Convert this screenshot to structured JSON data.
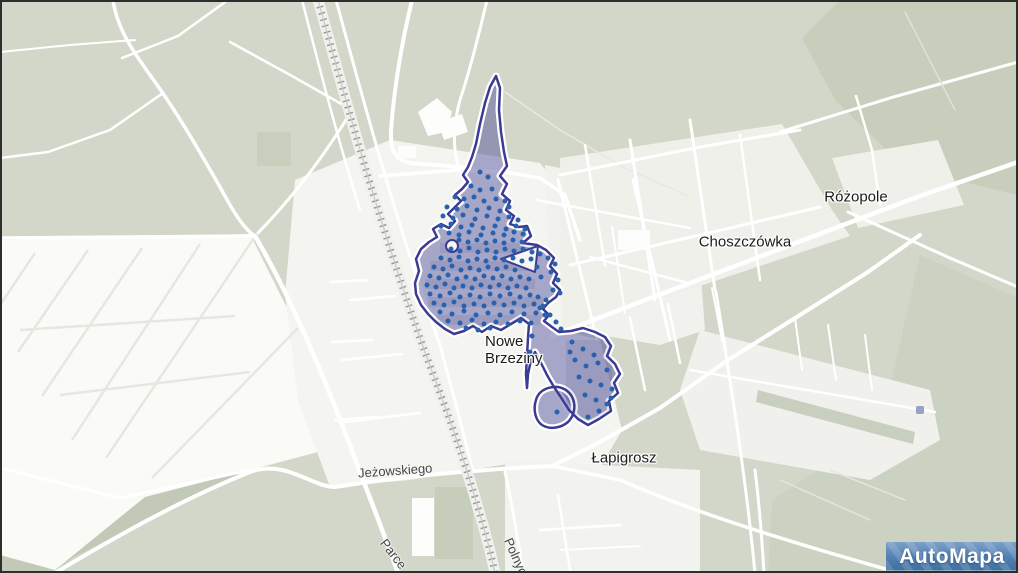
{
  "map": {
    "place_labels": [
      {
        "text": "Różopole"
      },
      {
        "text": "Choszczówka"
      },
      {
        "line1": "Nowe",
        "line2": "Brzeziny"
      },
      {
        "text": "Łapigrosz"
      }
    ],
    "street_labels": [
      {
        "text": "Jeżowskiego"
      },
      {
        "text": "Parce"
      },
      {
        "text": "Polnych"
      }
    ],
    "logo": {
      "text": "AutoMapa"
    },
    "district": {
      "name": "Nowe Brzeziny",
      "fill": "rgba(70,70,150,0.45)",
      "stroke": "#3b3b94",
      "halo": "#ffffff"
    },
    "colors": {
      "base_green": "#d3d7c9",
      "dark_green": "#c7cebc",
      "urban_light": "#f4f4f0",
      "road_white": "#ffffff",
      "dot_blue": "#2a61ae",
      "railway_gray": "#9a9a98",
      "logo_blue": "#517fb0"
    },
    "building_dots": [
      [
        480,
        172
      ],
      [
        488,
        177
      ],
      [
        471,
        186
      ],
      [
        480,
        190
      ],
      [
        492,
        189
      ],
      [
        455,
        197
      ],
      [
        464,
        199
      ],
      [
        474,
        197
      ],
      [
        484,
        201
      ],
      [
        496,
        199
      ],
      [
        505,
        201
      ],
      [
        447,
        207
      ],
      [
        457,
        209
      ],
      [
        467,
        206
      ],
      [
        477,
        210
      ],
      [
        489,
        208
      ],
      [
        500,
        211
      ],
      [
        509,
        207
      ],
      [
        443,
        216
      ],
      [
        453,
        218
      ],
      [
        463,
        215
      ],
      [
        475,
        219
      ],
      [
        487,
        216
      ],
      [
        498,
        219
      ],
      [
        509,
        217
      ],
      [
        518,
        220
      ],
      [
        441,
        226
      ],
      [
        451,
        224
      ],
      [
        461,
        227
      ],
      [
        472,
        225
      ],
      [
        483,
        228
      ],
      [
        495,
        226
      ],
      [
        506,
        229
      ],
      [
        516,
        226
      ],
      [
        525,
        229
      ],
      [
        449,
        233
      ],
      [
        459,
        235
      ],
      [
        469,
        232
      ],
      [
        481,
        235
      ],
      [
        493,
        233
      ],
      [
        504,
        235
      ],
      [
        514,
        232
      ],
      [
        523,
        234
      ],
      [
        459,
        240
      ],
      [
        468,
        242
      ],
      [
        477,
        240
      ],
      [
        486,
        243
      ],
      [
        495,
        241
      ],
      [
        504,
        243
      ],
      [
        513,
        240
      ],
      [
        522,
        242
      ],
      [
        451,
        249
      ],
      [
        460,
        251
      ],
      [
        469,
        248
      ],
      [
        478,
        252
      ],
      [
        487,
        250
      ],
      [
        496,
        252
      ],
      [
        505,
        249
      ],
      [
        514,
        251
      ],
      [
        523,
        249
      ],
      [
        532,
        252
      ],
      [
        441,
        258
      ],
      [
        450,
        260
      ],
      [
        459,
        257
      ],
      [
        468,
        261
      ],
      [
        477,
        259
      ],
      [
        486,
        261
      ],
      [
        495,
        258
      ],
      [
        504,
        260
      ],
      [
        513,
        258
      ],
      [
        522,
        261
      ],
      [
        531,
        259
      ],
      [
        434,
        267
      ],
      [
        443,
        269
      ],
      [
        452,
        266
      ],
      [
        461,
        270
      ],
      [
        470,
        268
      ],
      [
        479,
        270
      ],
      [
        488,
        267
      ],
      [
        497,
        269
      ],
      [
        506,
        267
      ],
      [
        515,
        270
      ],
      [
        430,
        276
      ],
      [
        439,
        278
      ],
      [
        448,
        275
      ],
      [
        457,
        279
      ],
      [
        466,
        277
      ],
      [
        475,
        279
      ],
      [
        484,
        276
      ],
      [
        493,
        278
      ],
      [
        502,
        276
      ],
      [
        511,
        279
      ],
      [
        520,
        277
      ],
      [
        529,
        279
      ],
      [
        427,
        285
      ],
      [
        436,
        287
      ],
      [
        445,
        284
      ],
      [
        454,
        288
      ],
      [
        463,
        286
      ],
      [
        472,
        288
      ],
      [
        481,
        285
      ],
      [
        490,
        287
      ],
      [
        499,
        285
      ],
      [
        508,
        288
      ],
      [
        517,
        286
      ],
      [
        526,
        288
      ],
      [
        430,
        294
      ],
      [
        440,
        296
      ],
      [
        450,
        293
      ],
      [
        460,
        297
      ],
      [
        470,
        295
      ],
      [
        480,
        297
      ],
      [
        490,
        294
      ],
      [
        500,
        296
      ],
      [
        510,
        294
      ],
      [
        520,
        297
      ],
      [
        530,
        295
      ],
      [
        538,
        297
      ],
      [
        434,
        303
      ],
      [
        444,
        305
      ],
      [
        454,
        302
      ],
      [
        464,
        306
      ],
      [
        474,
        304
      ],
      [
        484,
        306
      ],
      [
        494,
        303
      ],
      [
        504,
        305
      ],
      [
        514,
        303
      ],
      [
        524,
        306
      ],
      [
        534,
        304
      ],
      [
        543,
        306
      ],
      [
        440,
        312
      ],
      [
        452,
        314
      ],
      [
        464,
        311
      ],
      [
        476,
        315
      ],
      [
        488,
        313
      ],
      [
        500,
        315
      ],
      [
        512,
        312
      ],
      [
        524,
        314
      ],
      [
        536,
        313
      ],
      [
        545,
        315
      ],
      [
        448,
        321
      ],
      [
        460,
        323
      ],
      [
        472,
        320
      ],
      [
        484,
        324
      ],
      [
        496,
        322
      ],
      [
        508,
        324
      ],
      [
        520,
        321
      ],
      [
        531,
        323
      ],
      [
        466,
        328
      ],
      [
        478,
        330
      ],
      [
        490,
        328
      ],
      [
        540,
        254
      ],
      [
        548,
        258
      ],
      [
        555,
        264
      ],
      [
        551,
        272
      ],
      [
        558,
        280
      ],
      [
        553,
        290
      ],
      [
        560,
        293
      ],
      [
        537,
        267
      ],
      [
        541,
        277
      ],
      [
        546,
        300
      ],
      [
        540,
        308
      ],
      [
        550,
        315
      ],
      [
        556,
        322
      ],
      [
        561,
        329
      ],
      [
        572,
        342
      ],
      [
        583,
        349
      ],
      [
        594,
        355
      ],
      [
        575,
        360
      ],
      [
        586,
        366
      ],
      [
        598,
        363
      ],
      [
        607,
        370
      ],
      [
        579,
        377
      ],
      [
        590,
        381
      ],
      [
        601,
        385
      ],
      [
        612,
        389
      ],
      [
        585,
        395
      ],
      [
        596,
        400
      ],
      [
        607,
        404
      ],
      [
        599,
        411
      ],
      [
        588,
        417
      ],
      [
        611,
        398
      ],
      [
        570,
        352
      ],
      [
        557,
        412
      ],
      [
        532,
        336
      ],
      [
        530,
        352
      ]
    ]
  }
}
